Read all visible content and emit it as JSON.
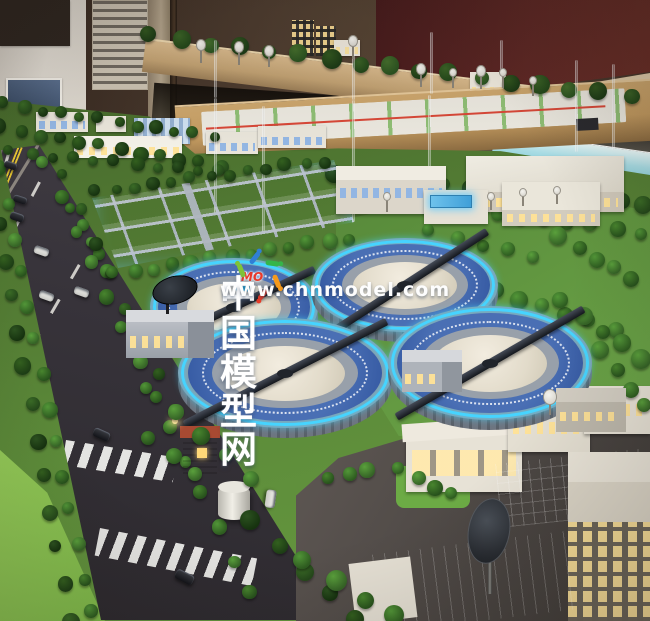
{
  "watermark": {
    "site_name": "中国模型网",
    "site_url": "www.chnmodel.com",
    "logo_text": "MO",
    "logo_colors": [
      "#2f7fd6",
      "#35b54a",
      "#f59a1d",
      "#e83c28",
      "#28b4e8",
      "#7fc438"
    ]
  },
  "palette": {
    "clarifier_glow_blue": "#46d4ff",
    "basin_water_blue": "#4a73c4",
    "road_asphalt": "#37333a",
    "lane_marking_yellow": "#e7c633",
    "model_lawn_green": "#5d8c3a",
    "tree_green_dark": "#27481c",
    "backdrop_wall_maroon": "#5f2825",
    "backdrop_wall_beige": "#dcc6a2",
    "building_white": "#ece8df",
    "window_glow_warm": "#ffe296",
    "window_glow_blue": "#8fb4e4"
  }
}
